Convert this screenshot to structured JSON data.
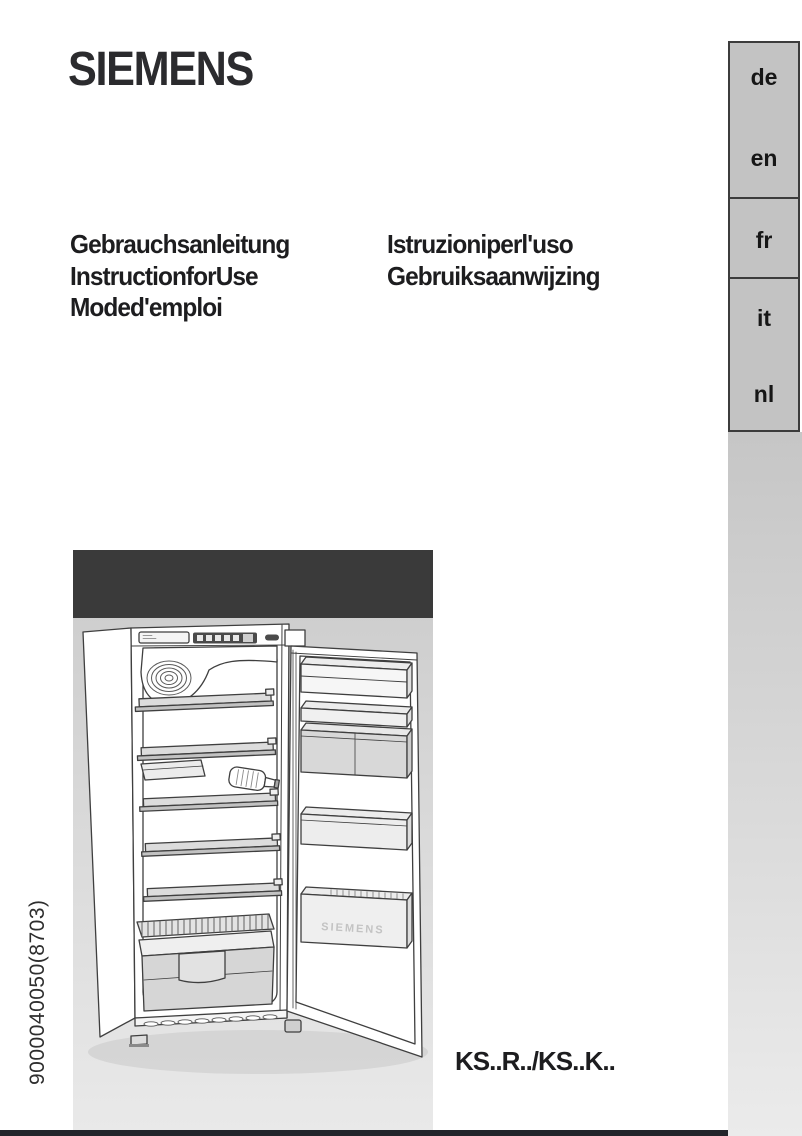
{
  "page": {
    "brand_logo": "SIEMENS",
    "doc_number": "9000040050(8703)",
    "model_code": "KS..R../KS..K.."
  },
  "titles": {
    "column1": [
      "Gebrauchsanleitung",
      "InstructionforUse",
      "Moded'emploi"
    ],
    "column2": [
      "Istruzioniperl'uso",
      "Gebruiksaanwijzing"
    ]
  },
  "language_tabs": [
    {
      "code": "de"
    },
    {
      "code": "en"
    },
    {
      "code": "fr"
    },
    {
      "code": "it"
    },
    {
      "code": "nl"
    }
  ],
  "illustration": {
    "name": "refrigerator-open-door-line-art",
    "embossed_text": "SIEMENS"
  },
  "colors": {
    "tab_panel": "#c3c3c3",
    "tab_border": "#3c3c3c",
    "image_header_band": "#3a3a3a",
    "bottom_bar": "#22252a",
    "text": "#1d1d1f"
  }
}
